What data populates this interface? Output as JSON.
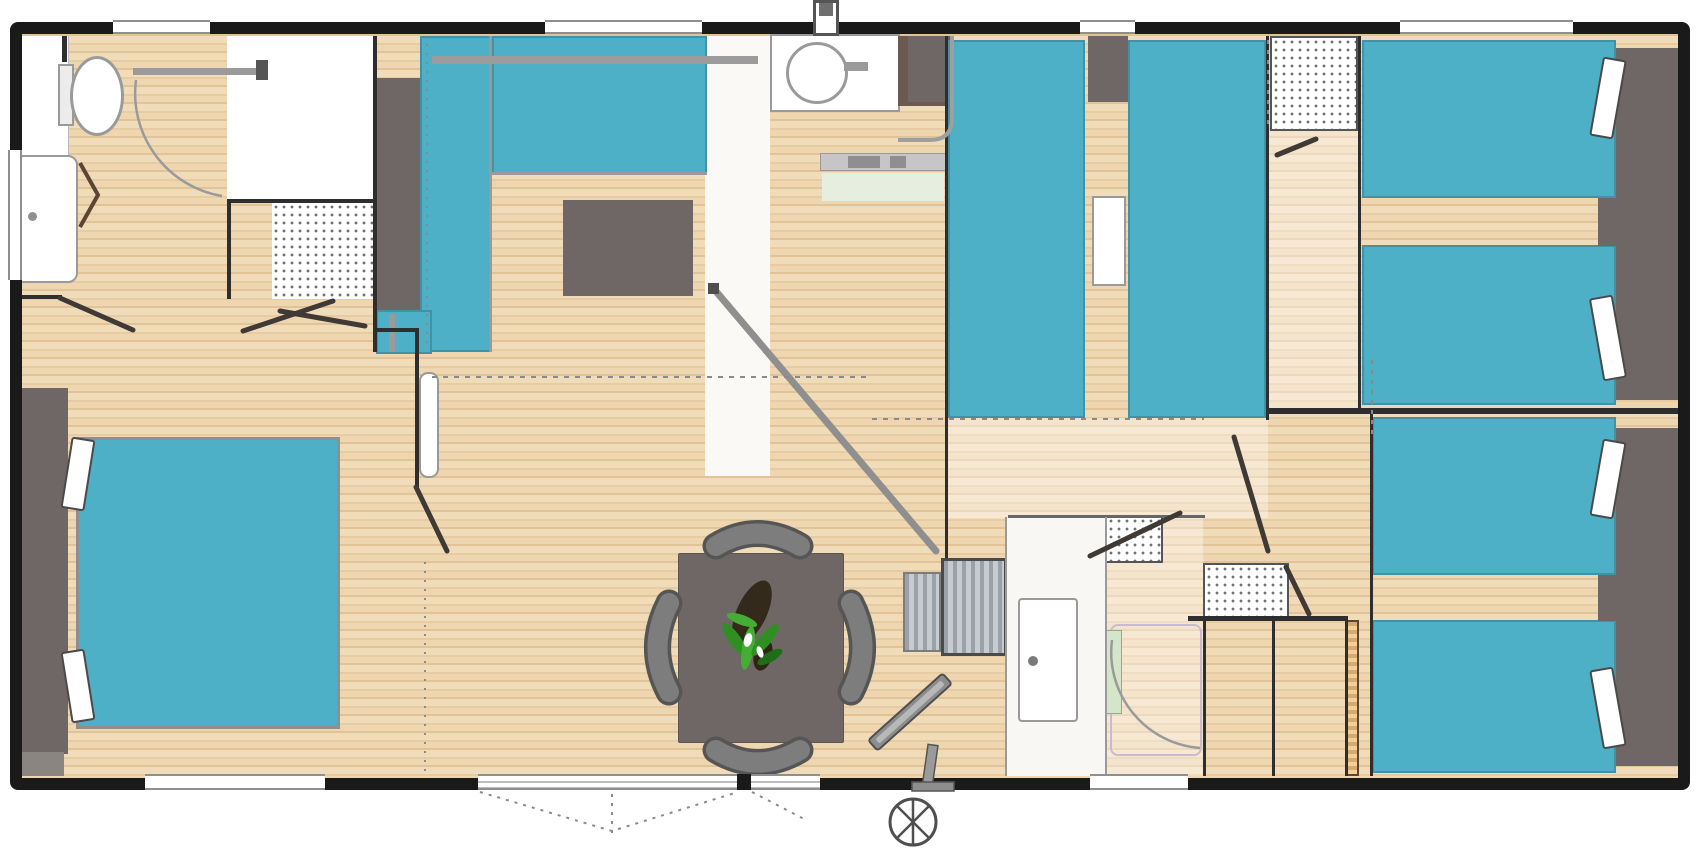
{
  "document": {
    "kind": "architectural-floor-plan",
    "subject": "mobile-home interior layout, top-down view",
    "visible_text": []
  },
  "palette": {
    "wall": "#1a1a1a",
    "wall-inner": "#2e2e2e",
    "floor": "#ecd2ac",
    "teal": "#4db0c6",
    "furniture-gray": "#6e6765",
    "outline-gray": "#9a9a9a",
    "appliance-brown": "#6a5a50",
    "plant-green": "#38a02c",
    "mat-green": "#e6eee0",
    "step-gray": "#aab0b6",
    "door-wood": "#5a4632"
  },
  "rooms": [
    {
      "name": "bathroom-left",
      "features": [
        "toilet",
        "shower-tray",
        "folding-door",
        "towel-rail",
        "storage-shelves",
        "window"
      ]
    },
    {
      "name": "master-bedroom",
      "features": [
        "double-bed",
        "headboard",
        "pillow",
        "pillow",
        "sliding-door",
        "window"
      ]
    },
    {
      "name": "kitchen",
      "features": [
        "l-shaped-counter",
        "tall-cabinet",
        "wall-rail",
        "island-unit",
        "window"
      ]
    },
    {
      "name": "living-dining",
      "features": [
        "dining-table",
        "chair",
        "chair",
        "chair",
        "chair",
        "plant",
        "tv-on-stand",
        "sliding-bay-window"
      ]
    },
    {
      "name": "entrance",
      "features": [
        "washbasin",
        "water-heater",
        "bench",
        "doormat",
        "railing",
        "interior-steps",
        "entrance-door",
        "roof-vent"
      ]
    },
    {
      "name": "middle-twin-bedroom",
      "features": [
        "single-bed",
        "single-bed",
        "headboard-cabinet",
        "headboard-cabinet",
        "nightstand",
        "window"
      ]
    },
    {
      "name": "hallway",
      "features": [
        "wardrobe-shelves",
        "open-door",
        "sliding-door-track"
      ]
    },
    {
      "name": "shower-room",
      "features": [
        "shower-enclosure",
        "washbasin",
        "storage-shelves",
        "door-swing"
      ]
    },
    {
      "name": "wc",
      "features": [
        "shelf-unit"
      ]
    },
    {
      "name": "bedroom-top-right",
      "features": [
        "single-bed",
        "single-bed",
        "headboard",
        "pillow",
        "pillow",
        "window"
      ]
    },
    {
      "name": "bedroom-bottom-right",
      "features": [
        "single-bed",
        "single-bed",
        "headboard",
        "pillow",
        "pillow",
        "window"
      ]
    },
    {
      "name": "exterior",
      "features": [
        "jockey-wheel",
        "door-swing-dashes"
      ]
    }
  ],
  "furniture_totals": {
    "double_beds": 1,
    "single_beds": 6,
    "dining_chairs": 4,
    "dining_tables": 1,
    "toilets": 1,
    "shower_trays": 2,
    "washbasins": 2,
    "televisions": 1,
    "plants": 1,
    "step_blocks": 2,
    "storage_dotted_units": 4
  }
}
